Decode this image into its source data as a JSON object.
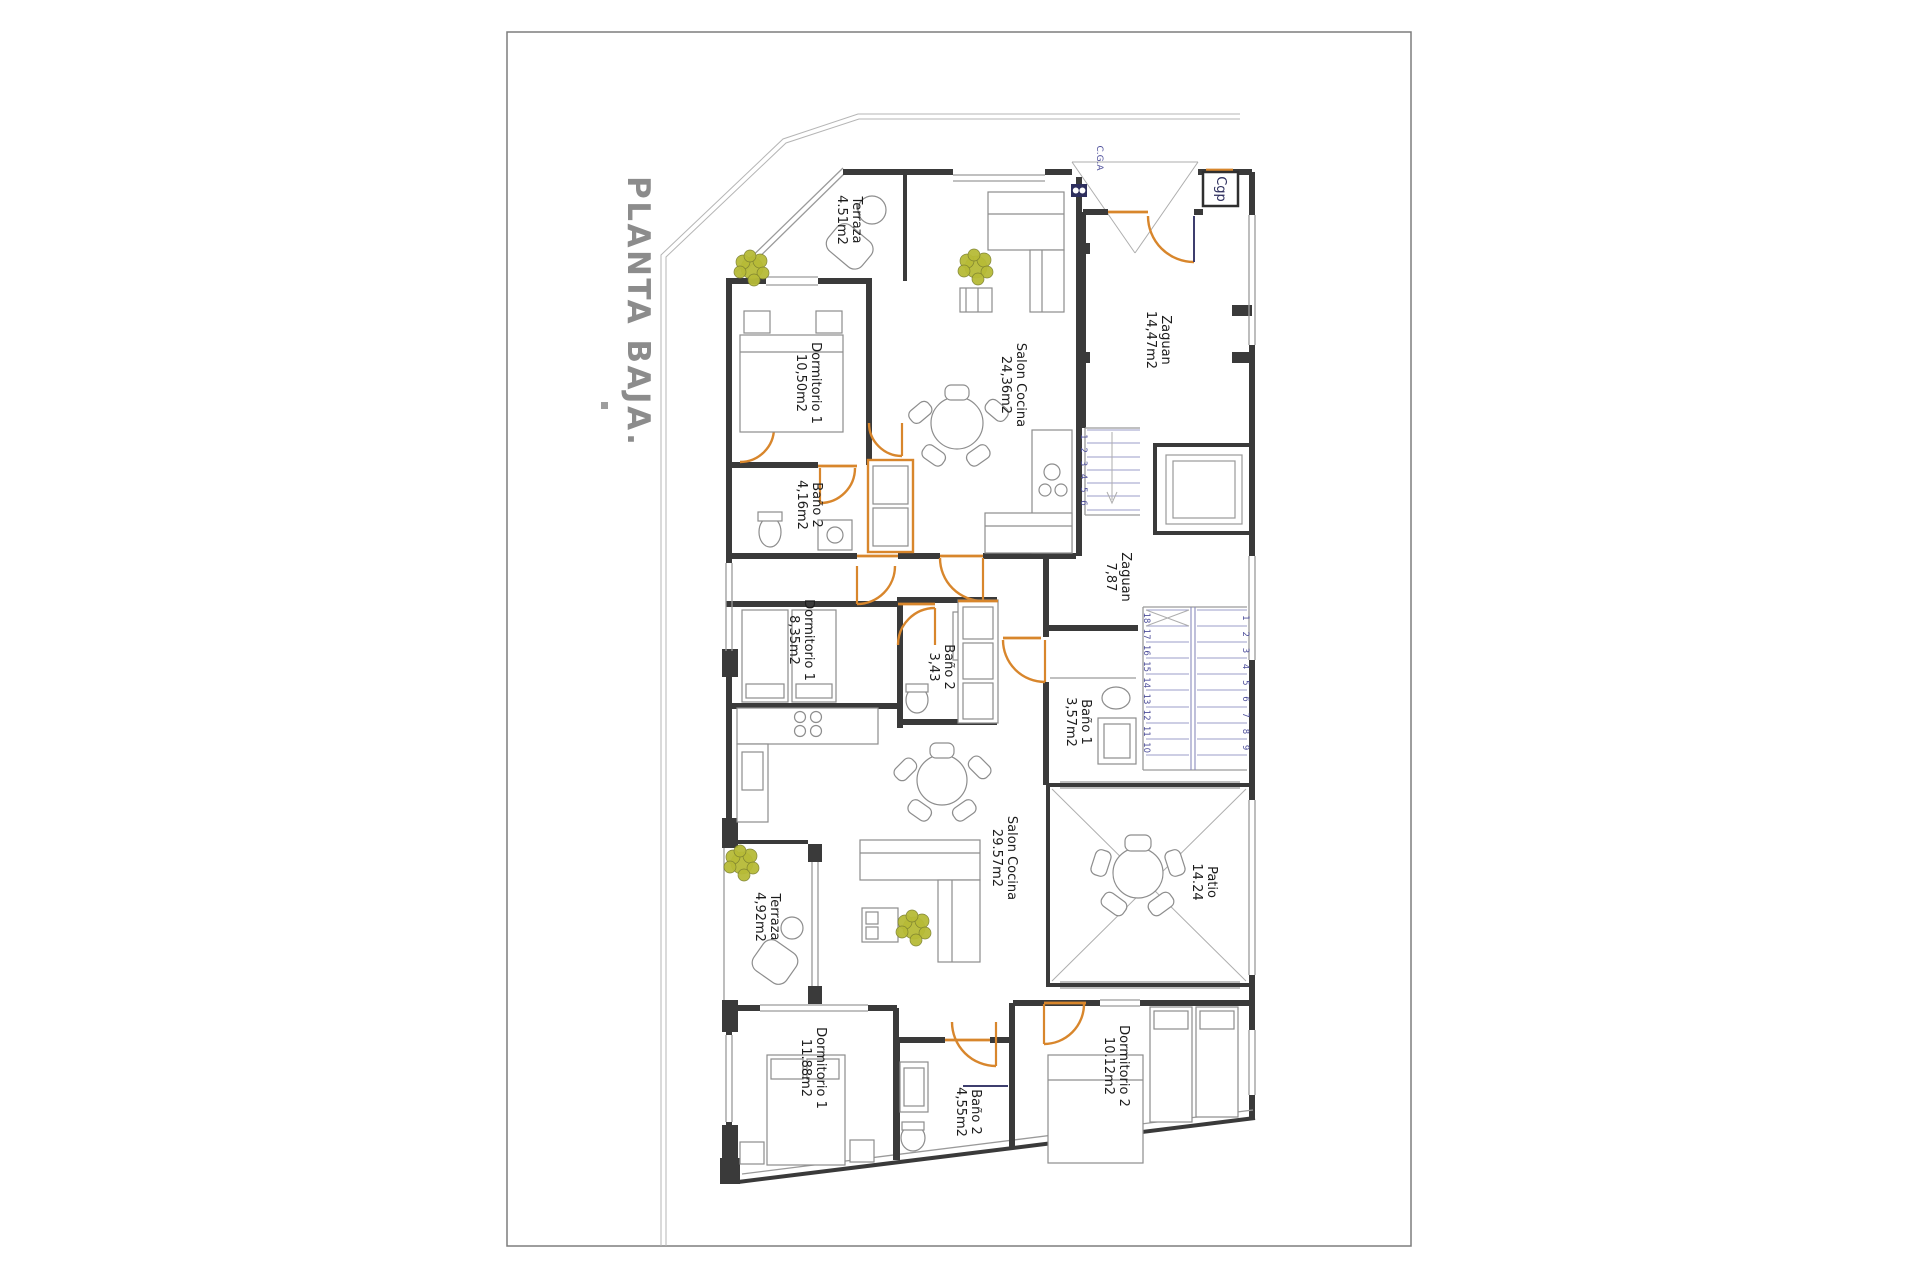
{
  "document": {
    "title": "PLANTA BAJA."
  },
  "annotations": {
    "cgp": "Cgp",
    "cga": "C.G.A"
  },
  "rooms": [
    {
      "name": "Terraza",
      "area": "4.51m2"
    },
    {
      "name": "Dormitorio 1",
      "area": "10,50m2"
    },
    {
      "name": "Salon Cocina",
      "area": "24,36m2"
    },
    {
      "name": "Zaguan",
      "area": "14,47m2"
    },
    {
      "name": "Baño 2",
      "area": "4,16m2"
    },
    {
      "name": "Dormitorio 1",
      "area": "8,35m2"
    },
    {
      "name": "Baño 2",
      "area": "3,43"
    },
    {
      "name": "Zaguan",
      "area": "7,87"
    },
    {
      "name": "Baño 1",
      "area": "3,57m2"
    },
    {
      "name": "Salon Cocina",
      "area": "29.57m2"
    },
    {
      "name": "Patio",
      "area": "14.24"
    },
    {
      "name": "Terraza",
      "area": "4,92m2"
    },
    {
      "name": "Dormitorio 1",
      "area": "11.88m2"
    },
    {
      "name": "Baño 2",
      "area": "4,55m2"
    },
    {
      "name": "Dormitorio 2",
      "area": "10.12m2"
    }
  ],
  "stairs": {
    "upper_flight": [
      "1",
      "2",
      "3",
      "4",
      "5",
      "6"
    ],
    "lower_flight_left": [
      "18",
      "17",
      "16",
      "15",
      "14",
      "13",
      "12",
      "11",
      "10"
    ],
    "lower_flight_right": [
      "1",
      "2",
      "3",
      "4",
      "5",
      "6",
      "7",
      "8",
      "9"
    ]
  },
  "colors": {
    "door_accent": "#d8862c",
    "stair_guide": "#9b9cc9",
    "door_leaf_blue": "#3d3e6e",
    "plant_green": "#b7bb37",
    "title_gray": "#8c8c8c",
    "wall_black": "#3a3a3a",
    "annotation_blue": "#4d4e9a"
  }
}
